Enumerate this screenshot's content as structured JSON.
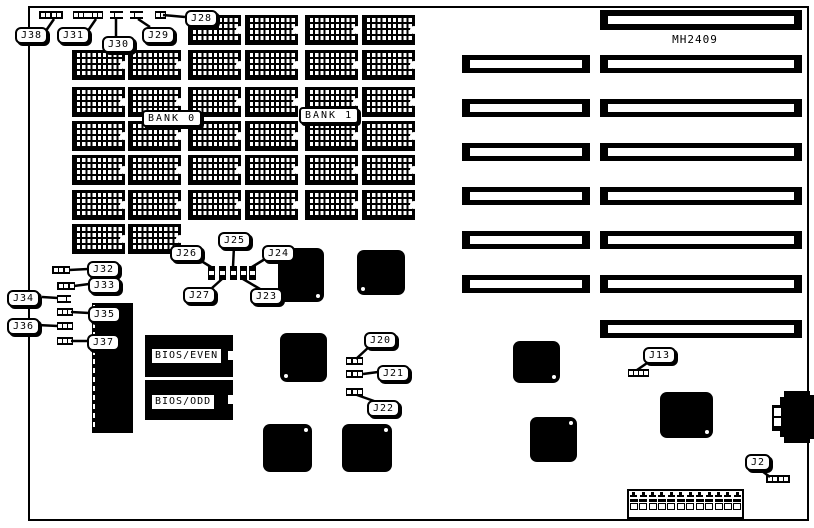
{
  "board": {
    "model": "MH2409",
    "memory": {
      "bank0_label": "BANK 0",
      "bank1_label": "BANK 1",
      "dram_chip_count": 36
    },
    "bios": {
      "even_label": "BIOS/EVEN",
      "odd_label": "BIOS/ODD"
    },
    "jumpers": {
      "J2": "J2",
      "J13": "J13",
      "J20": "J20",
      "J21": "J21",
      "J22": "J22",
      "J23": "J23",
      "J24": "J24",
      "J25": "J25",
      "J26": "J26",
      "J27": "J27",
      "J28": "J28",
      "J29": "J29",
      "J30": "J30",
      "J31": "J31",
      "J32": "J32",
      "J33": "J33",
      "J34": "J34",
      "J35": "J35",
      "J36": "J36",
      "J37": "J37",
      "J38": "J38"
    },
    "expansion_slots": {
      "long_slot_count": 8,
      "short_slot_count": 6
    },
    "power_connector_pin_count": 12
  }
}
